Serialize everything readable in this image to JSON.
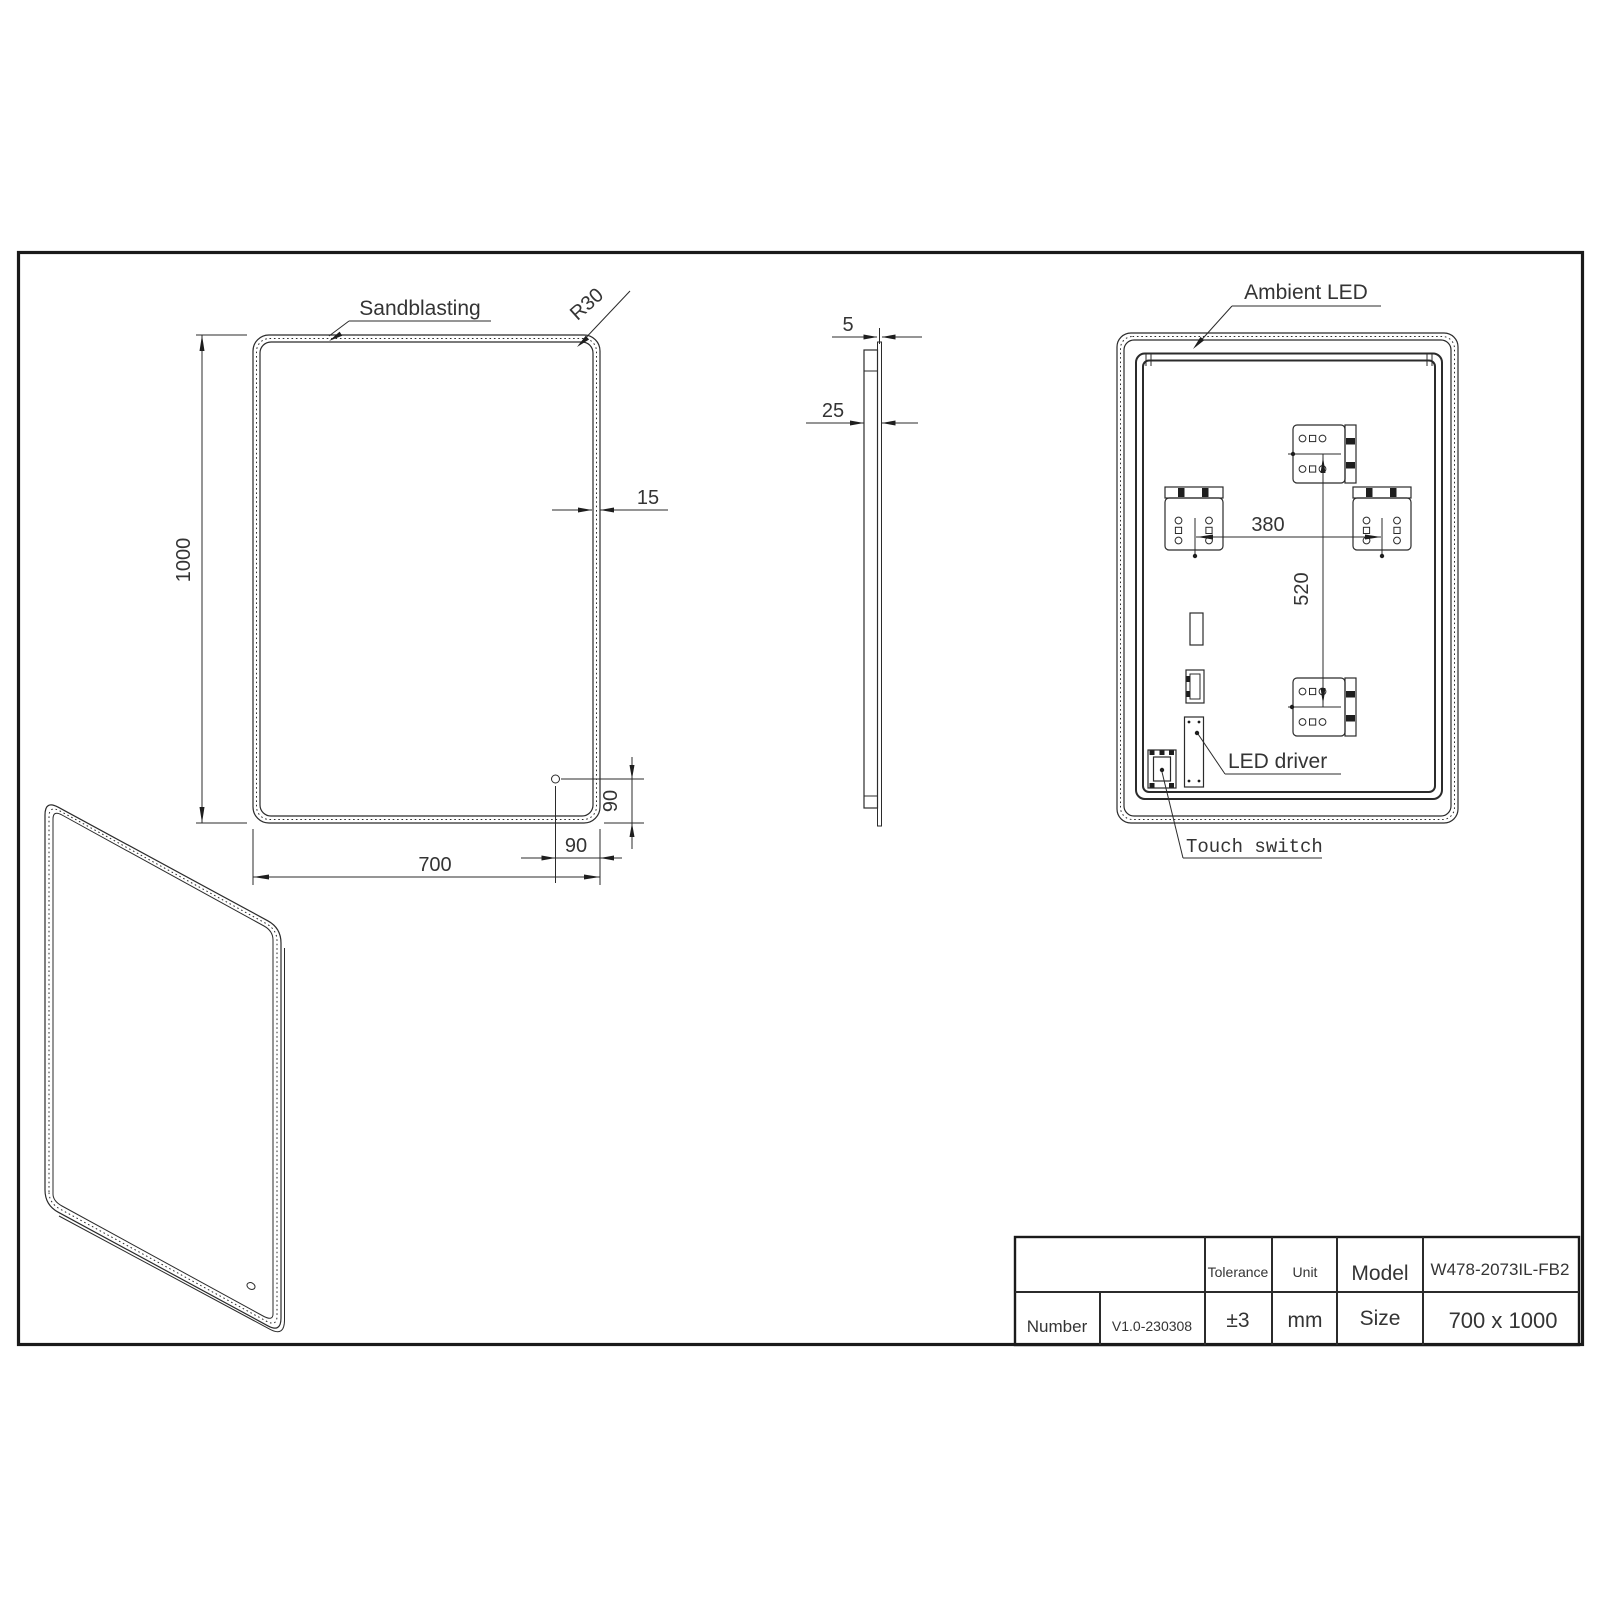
{
  "front": {
    "sandblasting": "Sandblasting",
    "radius": "R30",
    "height": "1000",
    "width": "700",
    "border": "15",
    "sensor_right": "90",
    "sensor_bottom": "90"
  },
  "side": {
    "glass": "5",
    "depth": "25"
  },
  "back": {
    "ambient": "Ambient LED",
    "driver": "LED driver",
    "touch": "Touch switch",
    "bracket_span": "380",
    "bracket_vert": "520"
  },
  "table": {
    "tolerance_label": "Tolerance",
    "tolerance": "±3",
    "unit_label": "Unit",
    "unit": "mm",
    "model_label": "Model",
    "model": "W478-2073IL-FB2",
    "number_label": "Number",
    "number": "V1.0-230308",
    "size_label": "Size",
    "size": "700 x 1000"
  },
  "colors": {
    "line": "#2b2b2b",
    "background": "#ffffff"
  }
}
